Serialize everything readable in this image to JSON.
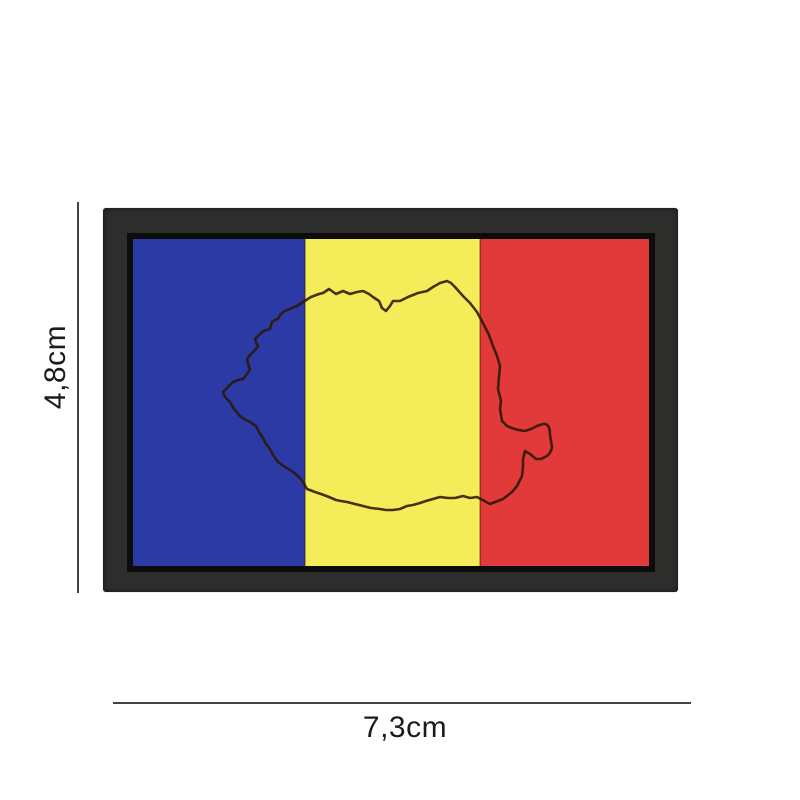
{
  "page": {
    "background_color": "#ffffff",
    "subject": "romania-flag-pvc-patch-with-map-outline"
  },
  "patch": {
    "frame_color": "#2d2d2c",
    "inner_border_color": "#0c0c0c",
    "stripes": [
      {
        "name": "blue",
        "color": "#2c3aa6"
      },
      {
        "name": "yellow",
        "color": "#f5ec5a"
      },
      {
        "name": "red",
        "color": "#e23a3a"
      }
    ],
    "seam_color": "#401f08",
    "map_outline": {
      "name": "romania-map-outline",
      "color": "#2b1806"
    }
  },
  "dimensions": {
    "height_label": "4,8cm",
    "width_label": "7,3cm",
    "line_color": "#424242",
    "text_color": "#1b1b1b"
  }
}
